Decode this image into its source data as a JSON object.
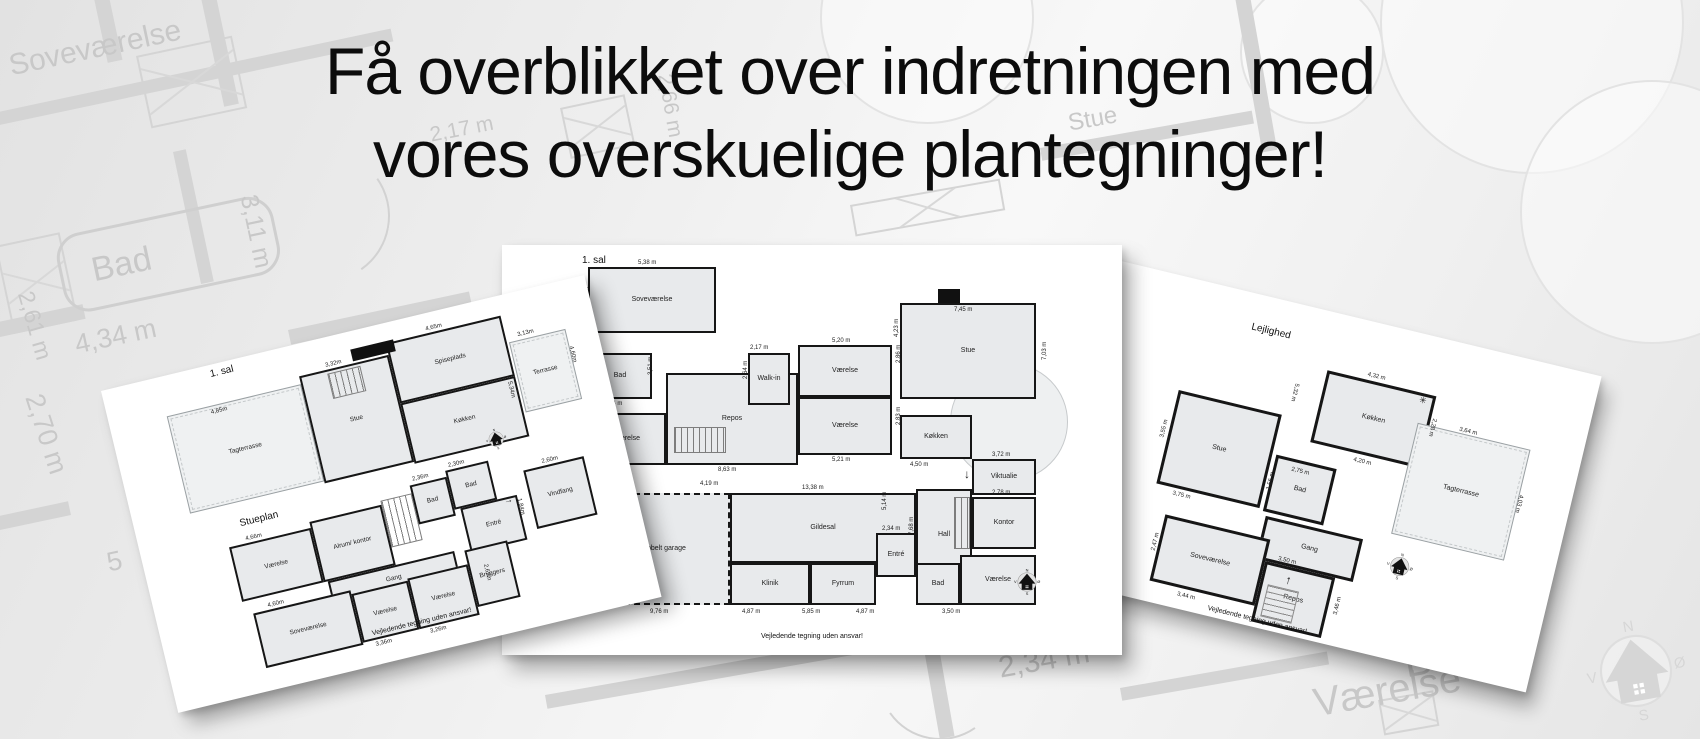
{
  "headline": {
    "line1": "Få overblikket over indretningen med",
    "line2": "vores overskuelige plantegninger!"
  },
  "compass_letters": {
    "n": "N",
    "e": "Ø",
    "s": "S",
    "w": "V"
  },
  "watermark": {
    "labels": [
      {
        "t": "Soveværelse",
        "x": 6,
        "y": 50,
        "s": 30,
        "r": -12
      },
      {
        "t": "Bad",
        "x": 88,
        "y": 252,
        "s": 34,
        "r": -12
      },
      {
        "t": "3,11 m",
        "x": 262,
        "y": 192,
        "s": 25,
        "r": 78
      },
      {
        "t": "2,61 m",
        "x": 38,
        "y": 288,
        "s": 23,
        "r": 74
      },
      {
        "t": "4,34 m",
        "x": 72,
        "y": 330,
        "s": 27,
        "r": -12
      },
      {
        "t": "2,70 m",
        "x": 48,
        "y": 390,
        "s": 27,
        "r": 72
      },
      {
        "t": "5",
        "x": 104,
        "y": 548,
        "s": 27,
        "r": -12
      },
      {
        "t": "2,17 m",
        "x": 428,
        "y": 124,
        "s": 21,
        "r": -11
      },
      {
        "t": "2,66 m",
        "x": 676,
        "y": 72,
        "s": 21,
        "r": 80
      },
      {
        "t": "Stue",
        "x": 1066,
        "y": 110,
        "s": 24,
        "r": -10
      },
      {
        "t": "Gildesal",
        "x": 716,
        "y": 612,
        "s": 36,
        "r": -10
      },
      {
        "t": "2,34 m",
        "x": 996,
        "y": 652,
        "s": 30,
        "r": -10
      },
      {
        "t": "Bad",
        "x": 1400,
        "y": 640,
        "s": 42,
        "r": -10
      },
      {
        "t": "Værelse",
        "x": 1310,
        "y": 682,
        "s": 40,
        "r": -10
      }
    ],
    "walls": [
      {
        "x": -30,
        "y": 118,
        "w": 430,
        "h": 13,
        "r": -12
      },
      {
        "x": 88,
        "y": -30,
        "w": 15,
        "h": 95,
        "r": -12
      },
      {
        "x": 193,
        "y": -40,
        "w": 15,
        "h": 150,
        "r": -12
      },
      {
        "x": -30,
        "y": 328,
        "w": 115,
        "h": 15,
        "r": -12
      },
      {
        "x": 173,
        "y": 152,
        "w": 13,
        "h": 135,
        "r": -12
      },
      {
        "x": 288,
        "y": 330,
        "w": 185,
        "h": 15,
        "r": -12
      },
      {
        "x": 366,
        "y": 350,
        "w": 13,
        "h": 115,
        "r": -12
      },
      {
        "x": -20,
        "y": 520,
        "w": 90,
        "h": 14,
        "r": -12
      },
      {
        "x": 545,
        "y": 695,
        "w": 320,
        "h": 14,
        "r": -10
      },
      {
        "x": 925,
        "y": 655,
        "w": 15,
        "h": 85,
        "r": -10
      },
      {
        "x": 1120,
        "y": 688,
        "w": 210,
        "h": 13,
        "r": -10
      },
      {
        "x": 1040,
        "y": 148,
        "w": 215,
        "h": 13,
        "r": -10
      },
      {
        "x": 1232,
        "y": -20,
        "w": 15,
        "h": 175,
        "r": -10
      }
    ],
    "windows": [
      {
        "x": -5,
        "y": 246,
        "w": 62,
        "h": 86,
        "r": -12
      },
      {
        "x": 136,
        "y": 56,
        "w": 94,
        "h": 70,
        "r": -12
      },
      {
        "x": 850,
        "y": 205,
        "w": 148,
        "h": 28,
        "r": -10
      },
      {
        "x": 560,
        "y": 108,
        "w": 62,
        "h": 48,
        "r": -12
      },
      {
        "x": 1378,
        "y": 700,
        "w": 52,
        "h": 32,
        "r": -10
      }
    ],
    "tub": {
      "x": 52,
      "y": 238,
      "w": 215,
      "h": 74,
      "r": -12
    },
    "arcs": [
      {
        "x": 258,
        "y": 150,
        "d": 128,
        "r": 100
      },
      {
        "x": 498,
        "y": 388,
        "d": 128,
        "r": 10
      },
      {
        "x": 878,
        "y": 616,
        "d": 120,
        "r": 190
      },
      {
        "x": 1060,
        "y": 420,
        "d": 110,
        "r": 300
      }
    ],
    "trees": [
      {
        "x": 1380,
        "y": -130,
        "d": 300
      },
      {
        "x": 1520,
        "y": 80,
        "d": 260
      },
      {
        "x": 1240,
        "y": -20,
        "d": 140
      },
      {
        "x": 820,
        "y": -90,
        "d": 210
      }
    ],
    "compass": {
      "x": 1583,
      "y": 618,
      "d": 106,
      "r": -10
    }
  },
  "cards": [
    {
      "id": "left",
      "x": 101,
      "y": 391,
      "w": 497,
      "h": 331,
      "rot": -13.5,
      "titles": [
        {
          "t": "1. sal",
          "x": 110,
          "y": 4
        },
        {
          "t": "Stueplan",
          "x": 104,
          "y": 156
        }
      ],
      "rooms": [
        {
          "t": "Tagterrasse",
          "x": 58,
          "y": 40,
          "w": 138,
          "h": 100,
          "type": "terrace"
        },
        {
          "t": "Stue",
          "x": 196,
          "y": 32,
          "w": 92,
          "h": 110
        },
        {
          "t": "Spiseplads",
          "x": 288,
          "y": 20,
          "w": 118,
          "h": 62
        },
        {
          "t": "Køkken",
          "x": 288,
          "y": 82,
          "w": 118,
          "h": 62
        },
        {
          "t": "Terrasse",
          "x": 408,
          "y": 48,
          "w": 58,
          "h": 72,
          "type": "terrace"
        },
        {
          "t": "",
          "x": 224,
          "y": 36,
          "w": 34,
          "h": 26,
          "type": "stairs"
        },
        {
          "t": "Værelse",
          "x": 88,
          "y": 182,
          "w": 84,
          "h": 56
        },
        {
          "t": "Alrum/ kontor",
          "x": 172,
          "y": 176,
          "w": 74,
          "h": 62
        },
        {
          "t": "",
          "x": 246,
          "y": 172,
          "w": 32,
          "h": 48,
          "type": "stairs"
        },
        {
          "t": "Bad",
          "x": 278,
          "y": 164,
          "w": 38,
          "h": 40
        },
        {
          "t": "Bad",
          "x": 316,
          "y": 158,
          "w": 44,
          "h": 40
        },
        {
          "t": "Entré",
          "x": 322,
          "y": 198,
          "w": 58,
          "h": 46
        },
        {
          "t": "Vindfang",
          "x": 392,
          "y": 176,
          "w": 62,
          "h": 60
        },
        {
          "t": "Gang",
          "x": 176,
          "y": 238,
          "w": 130,
          "h": 26
        },
        {
          "t": "Soveværelse",
          "x": 96,
          "y": 252,
          "w": 100,
          "h": 56
        },
        {
          "t": "Værelse",
          "x": 196,
          "y": 256,
          "w": 58,
          "h": 50
        },
        {
          "t": "Værelse",
          "x": 254,
          "y": 254,
          "w": 62,
          "h": 52
        },
        {
          "t": "Bryggers",
          "x": 316,
          "y": 240,
          "w": 44,
          "h": 58
        }
      ],
      "blocks": [
        {
          "x": 252,
          "y": 18,
          "w": 44,
          "h": 12
        }
      ],
      "dims": [
        {
          "t": "4,85m",
          "x": 102,
          "y": 44
        },
        {
          "t": "3,32m",
          "x": 224,
          "y": 25
        },
        {
          "t": "4,65m",
          "x": 330,
          "y": 13
        },
        {
          "t": "3,13m",
          "x": 418,
          "y": 40
        },
        {
          "t": "4,60m",
          "x": 470,
          "y": 66,
          "r": 90
        },
        {
          "t": "5,34m",
          "x": 402,
          "y": 86,
          "r": 90
        },
        {
          "t": "4,66m",
          "x": 106,
          "y": 175
        },
        {
          "t": "2,36m",
          "x": 282,
          "y": 156
        },
        {
          "t": "2,30m",
          "x": 320,
          "y": 151
        },
        {
          "t": "2,60m",
          "x": 412,
          "y": 169
        },
        {
          "t": "1,84m",
          "x": 384,
          "y": 202,
          "r": 90
        },
        {
          "t": "4,60m",
          "x": 112,
          "y": 245
        },
        {
          "t": "3,36m",
          "x": 208,
          "y": 308
        },
        {
          "t": "3,26m",
          "x": 264,
          "y": 308
        },
        {
          "t": "2,62m",
          "x": 336,
          "y": 258,
          "r": 90
        },
        {
          "t": "→",
          "x": 366,
          "y": 196,
          "s": 9
        }
      ],
      "compass": {
        "x": 362,
        "y": 128,
        "d": 22
      },
      "footer": {
        "t": "Vejledende tegning uden ansvar!",
        "x": 258,
        "y": 296
      }
    },
    {
      "id": "middle",
      "x": 502,
      "y": 245,
      "w": 620,
      "h": 410,
      "rot": 0,
      "titles": [
        {
          "t": "1. sal",
          "x": 80,
          "y": 10
        }
      ],
      "shapes": [
        {
          "x": 448,
          "y": 118,
          "d": 116
        }
      ],
      "rooms": [
        {
          "t": "Soveværelse",
          "x": 86,
          "y": 22,
          "w": 128,
          "h": 66
        },
        {
          "t": "Bad",
          "x": 86,
          "y": 108,
          "w": 64,
          "h": 46
        },
        {
          "t": "Værelse",
          "x": 86,
          "y": 168,
          "w": 78,
          "h": 52
        },
        {
          "t": "Repos",
          "x": 164,
          "y": 128,
          "w": 132,
          "h": 92
        },
        {
          "t": "",
          "x": 172,
          "y": 182,
          "w": 52,
          "h": 26,
          "type": "stairs"
        },
        {
          "t": "Walk-in",
          "x": 246,
          "y": 108,
          "w": 42,
          "h": 52
        },
        {
          "t": "Værelse",
          "x": 296,
          "y": 100,
          "w": 94,
          "h": 52
        },
        {
          "t": "Værelse",
          "x": 296,
          "y": 152,
          "w": 94,
          "h": 58
        },
        {
          "t": "Dobbelt garage",
          "x": 92,
          "y": 248,
          "w": 136,
          "h": 112,
          "type": "garage"
        },
        {
          "t": "Gildesal",
          "x": 228,
          "y": 248,
          "w": 186,
          "h": 70
        },
        {
          "t": "Klinik",
          "x": 228,
          "y": 318,
          "w": 80,
          "h": 42
        },
        {
          "t": "Fyrrum",
          "x": 308,
          "y": 318,
          "w": 66,
          "h": 42
        },
        {
          "t": "Entré",
          "x": 374,
          "y": 288,
          "w": 40,
          "h": 44
        },
        {
          "t": "Hall",
          "x": 414,
          "y": 244,
          "w": 56,
          "h": 92
        },
        {
          "t": "Bad",
          "x": 414,
          "y": 318,
          "w": 44,
          "h": 42
        },
        {
          "t": "Værelse",
          "x": 458,
          "y": 310,
          "w": 76,
          "h": 50
        },
        {
          "t": "Kontor",
          "x": 470,
          "y": 252,
          "w": 64,
          "h": 52
        },
        {
          "t": "",
          "x": 452,
          "y": 252,
          "w": 16,
          "h": 52,
          "type": "stairs"
        },
        {
          "t": "Viktualie",
          "x": 470,
          "y": 214,
          "w": 64,
          "h": 36
        },
        {
          "t": "Køkken",
          "x": 398,
          "y": 170,
          "w": 72,
          "h": 44
        },
        {
          "t": "Stue",
          "x": 398,
          "y": 58,
          "w": 136,
          "h": 96
        }
      ],
      "blocks": [
        {
          "x": 436,
          "y": 44,
          "w": 22,
          "h": 14
        }
      ],
      "dims": [
        {
          "t": "5,38 m",
          "x": 136,
          "y": 15
        },
        {
          "t": "4,63 m",
          "x": 82,
          "y": 60,
          "r": -90
        },
        {
          "t": "2,61 m",
          "x": 83,
          "y": 134,
          "r": -90
        },
        {
          "t": "3,51 m",
          "x": 146,
          "y": 130,
          "r": -90
        },
        {
          "t": "4,34 m",
          "x": 102,
          "y": 156
        },
        {
          "t": "2,79 m",
          "x": 82,
          "y": 200,
          "r": -90
        },
        {
          "t": "5,16 m",
          "x": 104,
          "y": 222
        },
        {
          "t": "8,63 m",
          "x": 216,
          "y": 222
        },
        {
          "t": "4,19 m",
          "x": 198,
          "y": 236
        },
        {
          "t": "2,17 m",
          "x": 248,
          "y": 100
        },
        {
          "t": "2,64 m",
          "x": 241,
          "y": 134,
          "r": -90
        },
        {
          "t": "5,20 m",
          "x": 330,
          "y": 93
        },
        {
          "t": "2,86 m",
          "x": 394,
          "y": 118,
          "r": -90
        },
        {
          "t": "5,21 m",
          "x": 330,
          "y": 212
        },
        {
          "t": "2,83 m",
          "x": 394,
          "y": 180,
          "r": -90
        },
        {
          "t": "13,38 m",
          "x": 300,
          "y": 240
        },
        {
          "t": "9,76 m",
          "x": 148,
          "y": 364
        },
        {
          "t": "4,87 m",
          "x": 240,
          "y": 364
        },
        {
          "t": "5,85 m",
          "x": 300,
          "y": 364
        },
        {
          "t": "4,87 m",
          "x": 354,
          "y": 364
        },
        {
          "t": "3,50 m",
          "x": 440,
          "y": 364
        },
        {
          "t": "2,34 m",
          "x": 380,
          "y": 281
        },
        {
          "t": "7,68 m",
          "x": 407,
          "y": 290,
          "r": -90
        },
        {
          "t": "2,78 m",
          "x": 490,
          "y": 245
        },
        {
          "t": "3,72 m",
          "x": 490,
          "y": 207
        },
        {
          "t": "4,50 m",
          "x": 408,
          "y": 217
        },
        {
          "t": "7,45 m",
          "x": 452,
          "y": 62
        },
        {
          "t": "4,23 m",
          "x": 392,
          "y": 92,
          "r": -90
        },
        {
          "t": "7,03 m",
          "x": 540,
          "y": 115,
          "r": -90
        },
        {
          "t": "5,14 m",
          "x": 380,
          "y": 265,
          "r": -90
        },
        {
          "t": "↓",
          "x": 462,
          "y": 222,
          "s": 12
        }
      ],
      "compass": {
        "x": 511,
        "y": 323,
        "d": 28
      },
      "footer": {
        "t": "Vejledende tegning uden ansvar!",
        "x": 310,
        "y": 388
      }
    },
    {
      "id": "right",
      "x": 1096,
      "y": 255,
      "w": 520,
      "h": 325,
      "rot": 13.5,
      "titles": [
        {
          "t": "Lejlighed",
          "x": 168,
          "y": 28
        }
      ],
      "rooms": [
        {
          "t": "Køkken",
          "x": 252,
          "y": 58,
          "w": 112,
          "h": 74
        },
        {
          "t": "Stue",
          "x": 112,
          "y": 112,
          "w": 106,
          "h": 96
        },
        {
          "t": "Bad",
          "x": 222,
          "y": 152,
          "w": 62,
          "h": 58
        },
        {
          "t": "Gang",
          "x": 226,
          "y": 214,
          "w": 100,
          "h": 44
        },
        {
          "t": "Soveværelse",
          "x": 128,
          "y": 236,
          "w": 108,
          "h": 68
        },
        {
          "t": "Repos",
          "x": 236,
          "y": 258,
          "w": 72,
          "h": 62,
          "stairs": true
        },
        {
          "t": "Tagterrasse",
          "x": 352,
          "y": 88,
          "w": 116,
          "h": 114,
          "type": "terrace"
        }
      ],
      "blocks": [],
      "dims": [
        {
          "t": "4,32 m",
          "x": 292,
          "y": 50
        },
        {
          "t": "4,20 m",
          "x": 298,
          "y": 136
        },
        {
          "t": "2,28 m",
          "x": 370,
          "y": 80,
          "r": 90
        },
        {
          "t": "5,32 m",
          "x": 228,
          "y": 78,
          "r": 90
        },
        {
          "t": "3,55 m",
          "x": 104,
          "y": 162,
          "r": -90
        },
        {
          "t": "3,75 m",
          "x": 130,
          "y": 211
        },
        {
          "t": "2,75 m",
          "x": 240,
          "y": 160
        },
        {
          "t": "1,56 m",
          "x": 220,
          "y": 188,
          "r": -90
        },
        {
          "t": "3,50 m",
          "x": 248,
          "y": 250
        },
        {
          "t": "2,47 m",
          "x": 122,
          "y": 274,
          "r": -90
        },
        {
          "t": "3,44 m",
          "x": 158,
          "y": 308
        },
        {
          "t": "3,46 m",
          "x": 314,
          "y": 294,
          "r": -90
        },
        {
          "t": "3,64 m",
          "x": 394,
          "y": 82
        },
        {
          "t": "4,03 m",
          "x": 472,
          "y": 134,
          "r": 90
        },
        {
          "t": "↑",
          "x": 260,
          "y": 264,
          "s": 12
        },
        {
          "t": "✳",
          "x": 348,
          "y": 60,
          "s": 9
        }
      ],
      "compass": {
        "x": 354,
        "y": 218,
        "d": 28
      },
      "footer": {
        "t": "Vejledende tegning uden ansvar!",
        "x": 242,
        "y": 314
      }
    }
  ]
}
